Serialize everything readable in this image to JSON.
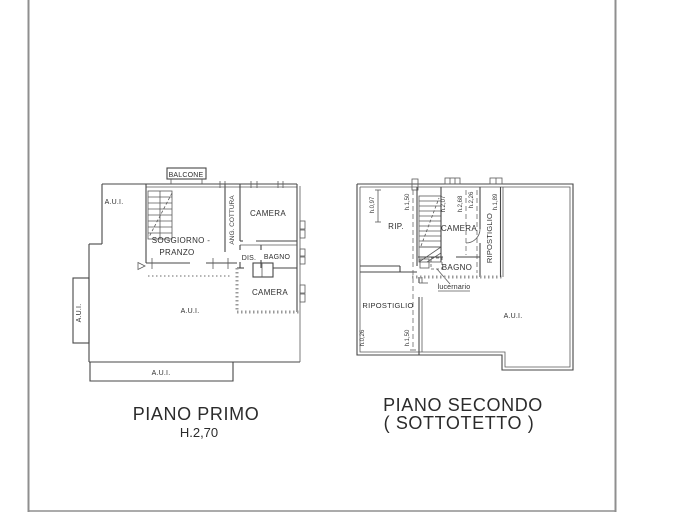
{
  "document": {
    "type": "real-estate floor plan drawing",
    "colors": {
      "background": "#ffffff",
      "ink": "#474747",
      "frame": "#8f8f8f",
      "hatch": "#9a9a9a"
    }
  },
  "floor1": {
    "caption": "PIANO PRIMO",
    "height_note": "H.2,70",
    "rooms": {
      "balcone": "BALCONE",
      "aui_top": "A.U.I.",
      "soggiorno_line1": "SOGGIORNO -",
      "soggiorno_line2": "PRANZO",
      "ang_cottura": "ANG. COTTURA",
      "camera_top": "CAMERA",
      "dis": "DIS.",
      "bagno": "BAGNO",
      "camera_bottom": "CAMERA",
      "aui_main": "A.U.I.",
      "aui_left": "A.U.I.",
      "aui_bottom": "A.U.I."
    }
  },
  "floor2": {
    "caption_line1": "PIANO SECONDO",
    "caption_line2": "( SOTTOTETTO )",
    "rooms": {
      "rip": "RIP.",
      "camera": "CAMERA",
      "ripostiglio_right": "RIPOSTIGLIO",
      "bagno": "BAGNO",
      "lucernario": "lucernario",
      "ripostiglio_left": "RIPOSTIGLIO",
      "aui": "A.U.I."
    },
    "heights": {
      "h1": "h.0,97",
      "h2": "h.1,50",
      "h3": "h.2,07",
      "h4": "h.2,68",
      "h5": "h.2,26",
      "h6": "h.1,89",
      "h7": "h.0,26",
      "h8": "h.1,50"
    }
  }
}
